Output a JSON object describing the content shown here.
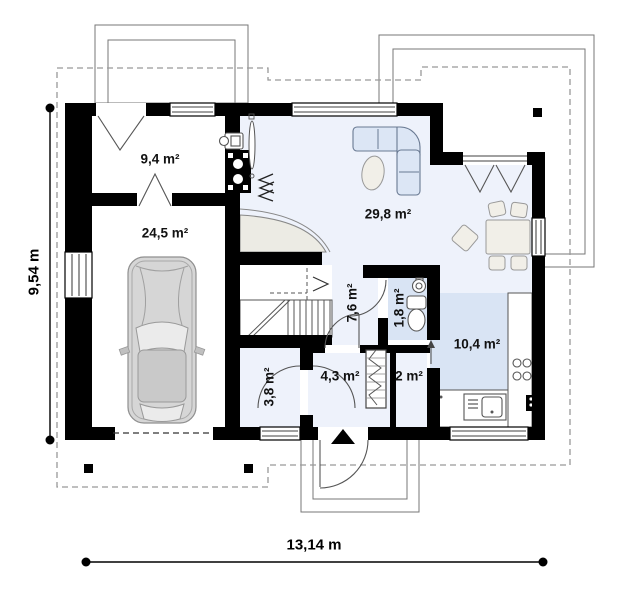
{
  "plan": {
    "dimensions": {
      "height": "9,54 m",
      "width": "13,14 m"
    },
    "rooms": [
      {
        "id": "utility-room",
        "area": "9,4 m²"
      },
      {
        "id": "garage",
        "area": "24,5 m²"
      },
      {
        "id": "living-room",
        "area": "29,8 m²"
      },
      {
        "id": "hall",
        "area": "7,6 m²"
      },
      {
        "id": "wc",
        "area": "1,8 m²"
      },
      {
        "id": "kitchen",
        "area": "10,4 m²"
      },
      {
        "id": "storage",
        "area": "3,8 m²"
      },
      {
        "id": "entry",
        "area": "4,3 m²"
      },
      {
        "id": "pantry",
        "area": "2 m²"
      }
    ]
  },
  "colors": {
    "wall": "#000000",
    "floor-main": "#eef2fb",
    "floor-wet": "#d9e4f4",
    "sofa": "#dce6f5",
    "furniture": "#f1efe8",
    "car-body": "#d6d6d6",
    "outline": "#666666",
    "dash": "#999999"
  }
}
